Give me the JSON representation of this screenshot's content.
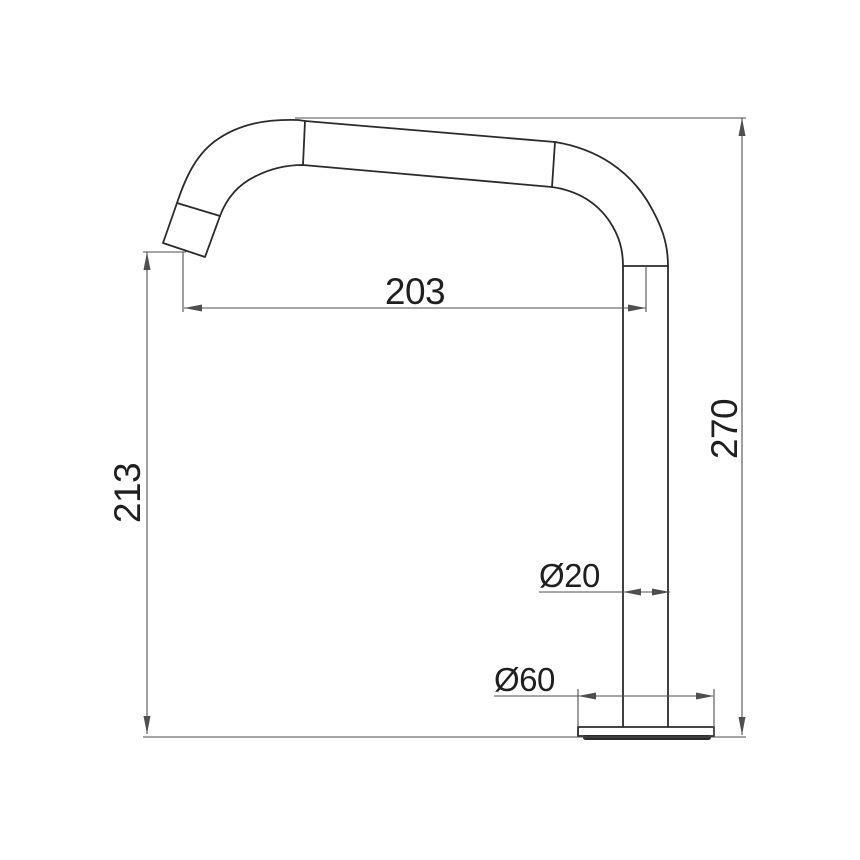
{
  "drawing": {
    "labels": {
      "reach": "203",
      "spout_height": "213",
      "overall_height": "270",
      "pipe_diameter": "Ø20",
      "base_diameter": "Ø60"
    },
    "colors": {
      "background": "#ffffff",
      "outline": "#2b2b2b",
      "dimension": "#4f4f4f",
      "text": "#1f1f1f"
    }
  }
}
